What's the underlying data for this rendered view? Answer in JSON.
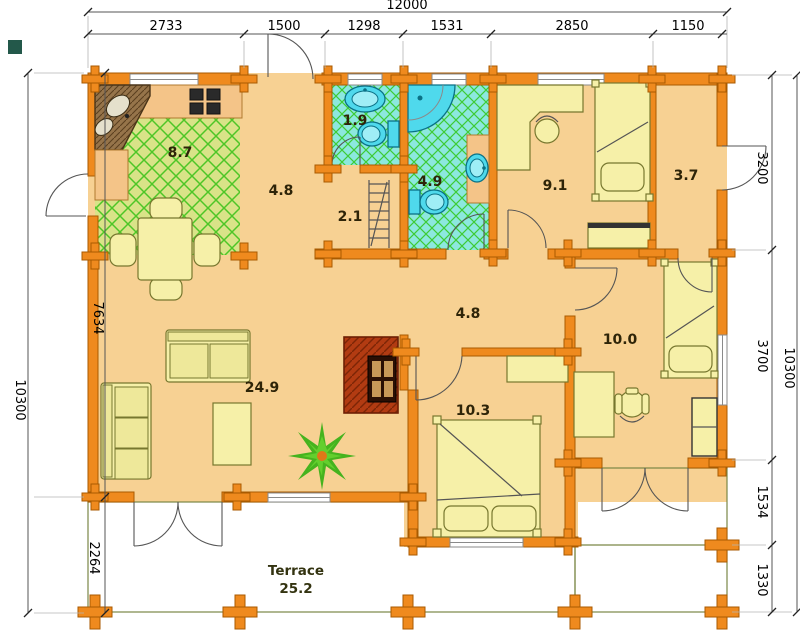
{
  "dimensions": {
    "top_total": "12000",
    "top_segments": [
      "2733",
      "1500",
      "1298",
      "1531",
      "2850",
      "1150"
    ],
    "left_total": "10300",
    "left_segments": [
      "7634",
      "2264"
    ],
    "right_total": "10300",
    "right_segments": [
      "3200",
      "3700",
      "1534",
      "1330"
    ]
  },
  "rooms": {
    "kitchen": "8.7",
    "hall_top": "4.8",
    "wc": "1.9",
    "bathroom": "4.9",
    "corridor": "2.1",
    "bedroom_top": "9.1",
    "entry": "3.7",
    "hall_middle": "4.8",
    "bedroom_right": "10.0",
    "living_room": "24.9",
    "bedroom_bottom": "10.3",
    "terrace_label": "Terrace",
    "terrace_area": "25.2"
  },
  "colors": {
    "wall": "#ef8a1e",
    "wall_border": "#a85a00",
    "floor": "#f7d193",
    "kitchen_floor": "#d9e388",
    "kitchen_lattice": "#4ec627",
    "bath_floor": "#8ce8de",
    "bath_lattice": "#3ecb35",
    "terrace_floor": "#cfda7e",
    "terrace_line": "#95a356",
    "furniture": "#f6f0a8",
    "fixture": "#4fd9ec",
    "fireplace": "#b23b12"
  }
}
